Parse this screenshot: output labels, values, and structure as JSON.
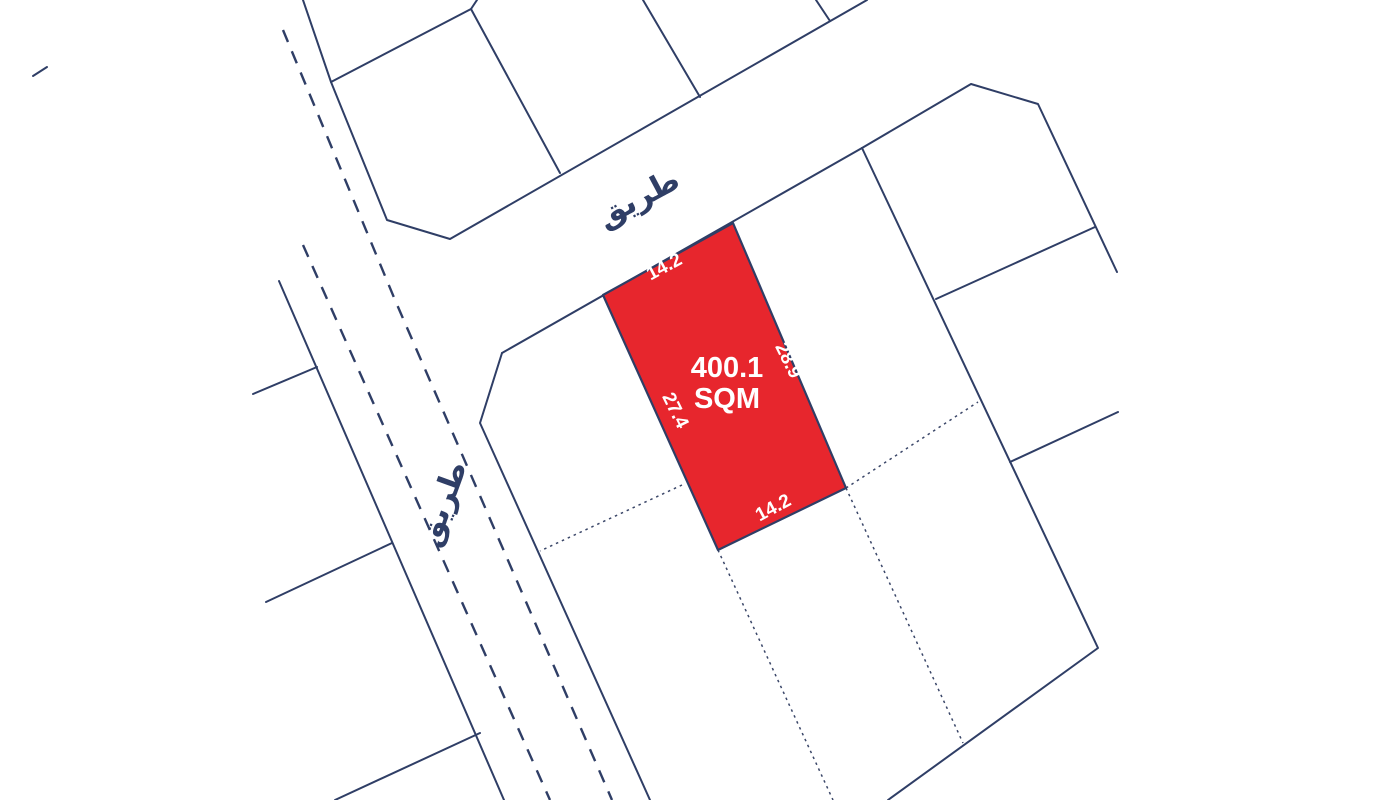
{
  "map": {
    "background_color": "#ffffff",
    "boundary_color": "#2f3e66",
    "plot_fill_color": "#e7262d",
    "plot_text_color": "#ffffff",
    "road_label_color": "#2f3e66",
    "highlighted_plot": {
      "area_value": "400.1",
      "area_unit": "SQM",
      "polygon": [
        [
          603,
          295
        ],
        [
          733,
          223
        ],
        [
          846,
          488
        ],
        [
          718,
          550
        ]
      ],
      "area_label_pos": {
        "x": 727,
        "y": 377
      },
      "dimension_labels": [
        {
          "text": "14.2",
          "x": 667,
          "y": 272,
          "rotate": -28
        },
        {
          "text": "28.9",
          "x": 783,
          "y": 363,
          "rotate": 64
        },
        {
          "text": "27.4",
          "x": 670,
          "y": 413,
          "rotate": 64
        },
        {
          "text": "14.2",
          "x": 776,
          "y": 513,
          "rotate": -28
        }
      ]
    },
    "road_labels": [
      {
        "text": "طريق",
        "x": 643,
        "y": 207,
        "rotate": -28
      },
      {
        "text": "طريق",
        "x": 452,
        "y": 507,
        "rotate": -70
      }
    ],
    "solid_lines": [
      [
        [
          303,
          0
        ],
        [
          331,
          82
        ],
        [
          387,
          220
        ],
        [
          450,
          239
        ],
        [
          867,
          0
        ]
      ],
      [
        [
          331,
          82
        ],
        [
          471,
          9
        ],
        [
          477,
          0
        ]
      ],
      [
        [
          471,
          9
        ],
        [
          560,
          173
        ]
      ],
      [
        [
          643,
          0
        ],
        [
          700,
          97
        ]
      ],
      [
        [
          830,
          21
        ],
        [
          816,
          0
        ]
      ],
      [
        [
          502,
          353
        ],
        [
          862,
          148
        ]
      ],
      [
        [
          279,
          281
        ],
        [
          504,
          800
        ]
      ],
      [
        [
          502,
          353
        ],
        [
          480,
          423
        ],
        [
          650,
          800
        ]
      ],
      [
        [
          317,
          367
        ],
        [
          253,
          394
        ]
      ],
      [
        [
          392,
          543
        ],
        [
          266,
          602
        ]
      ],
      [
        [
          480,
          733
        ],
        [
          335,
          800
        ]
      ],
      [
        [
          862,
          148
        ],
        [
          971,
          84
        ],
        [
          1038,
          104
        ],
        [
          1117,
          272
        ]
      ],
      [
        [
          862,
          148
        ],
        [
          1098,
          648
        ],
        [
          888,
          800
        ]
      ],
      [
        [
          936,
          299
        ],
        [
          1095,
          227
        ]
      ],
      [
        [
          1010,
          462
        ],
        [
          1118,
          412
        ]
      ],
      [
        [
          33,
          76
        ],
        [
          47,
          67
        ]
      ]
    ],
    "dotted_lines": [
      [
        [
          682,
          485
        ],
        [
          540,
          551
        ]
      ],
      [
        [
          718,
          550
        ],
        [
          833,
          800
        ]
      ],
      [
        [
          846,
          488
        ],
        [
          963,
          743
        ]
      ],
      [
        [
          846,
          488
        ],
        [
          978,
          402
        ]
      ]
    ],
    "dashed_lines": [
      [
        [
          283,
          30
        ],
        [
          395,
          300
        ],
        [
          612,
          800
        ]
      ],
      [
        [
          303,
          245
        ],
        [
          550,
          800
        ]
      ]
    ]
  }
}
